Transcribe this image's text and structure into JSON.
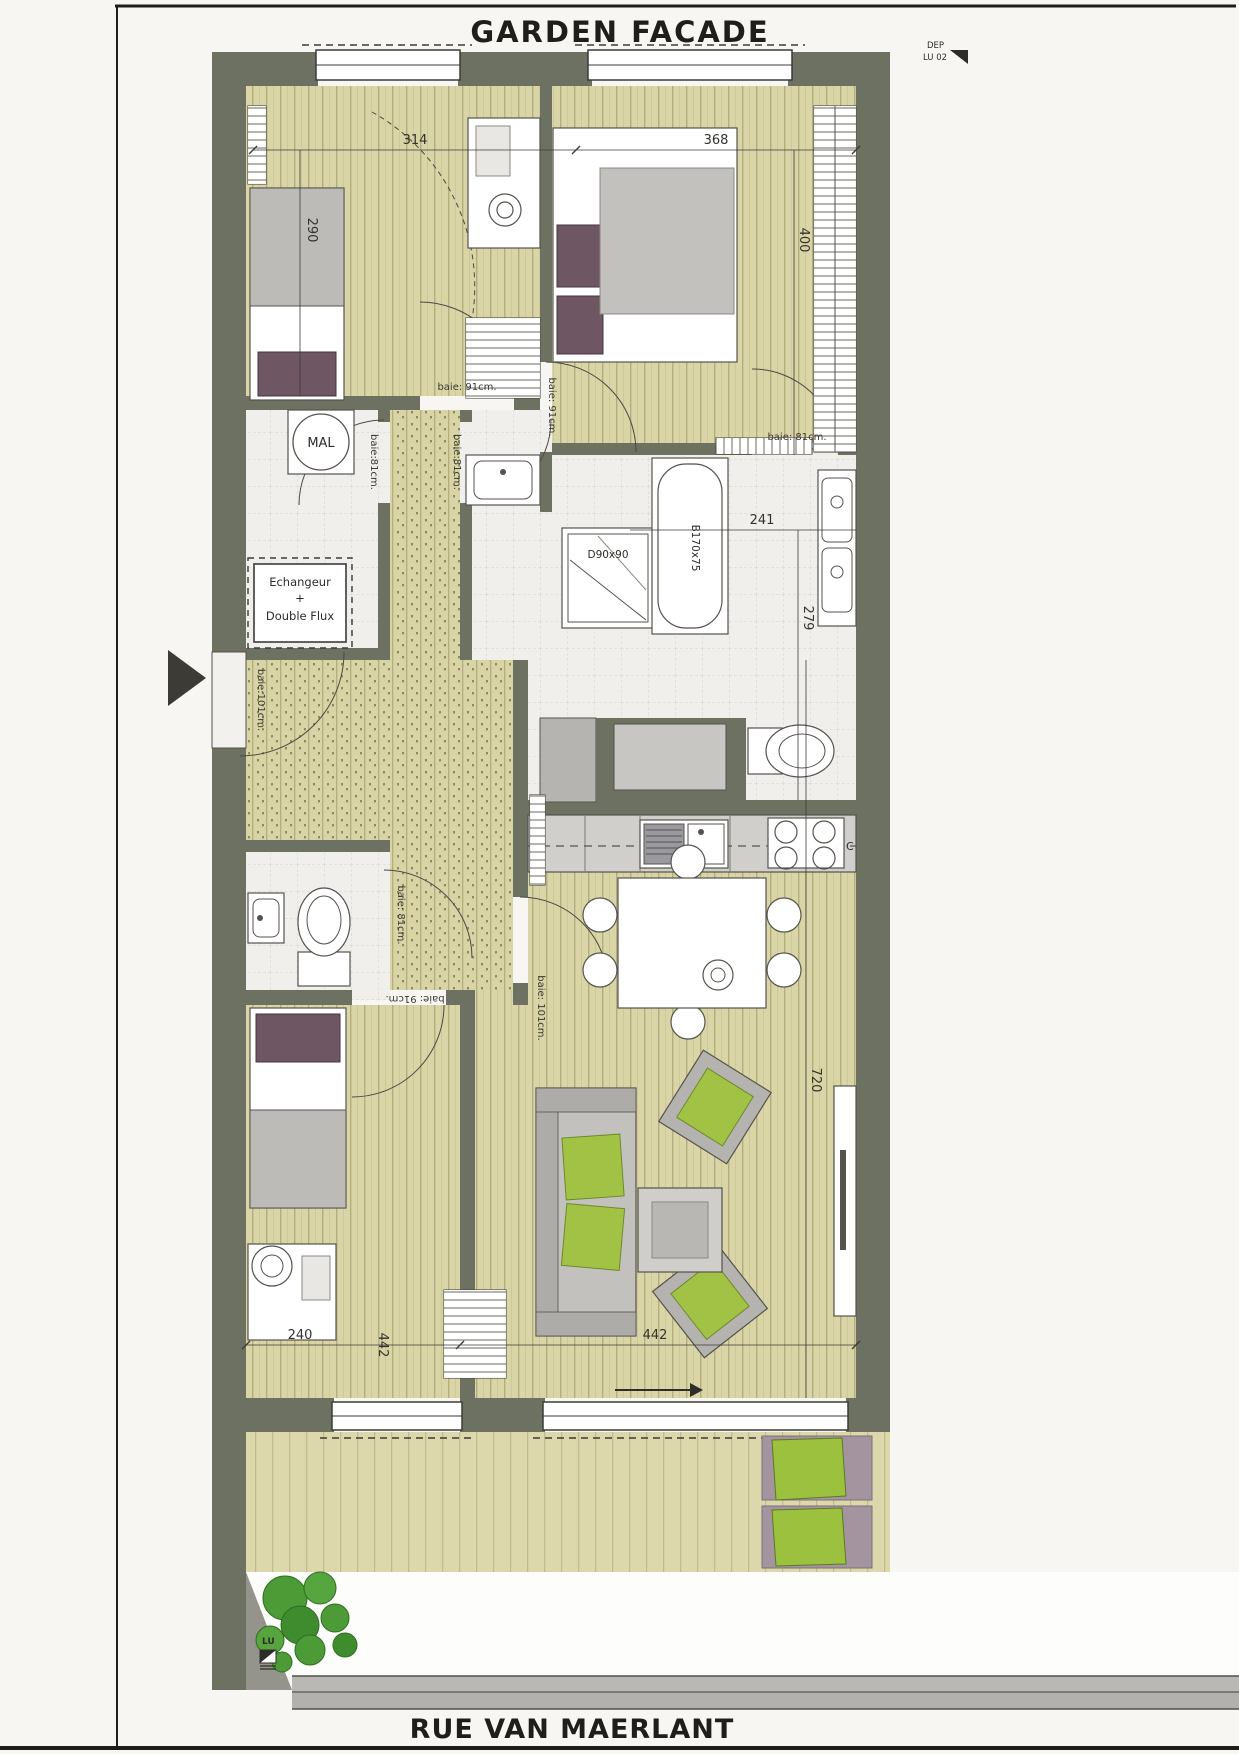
{
  "titles": {
    "garden_facade": "GARDEN FACADE",
    "street": "RUE VAN MAERLANT"
  },
  "sheet_marks": {
    "dep": "DEP",
    "lu02": "LU 02",
    "lu": "LU"
  },
  "equipment": {
    "washing_machine": "MAL",
    "hvac_line1": "Echangeur",
    "hvac_line2": "+",
    "hvac_line3": "Double Flux",
    "shower": "D90x90",
    "bathtub": "B170x75",
    "hob": "C"
  },
  "dimensions": {
    "bedroom1_width": "314",
    "bedroom2_width": "368",
    "bedroom1_depth": "290",
    "bedroom2_depth": "400",
    "bathroom_width": "241",
    "bathroom_depth": "279",
    "living_length": "720",
    "bedroom3_length": "442",
    "bedroom3_width": "240",
    "living_width": "442"
  },
  "door_labels": {
    "bedroom1_door": "baie: 91cm.",
    "bedroom2_door": "baie: 91cm.",
    "bathroom_top_door": "baie: 81cm.",
    "laundry_door": "baie:81cm.",
    "hall_door": "baie:81cm.",
    "entrance_door": "baie:101cm.",
    "wc_door": "baie: 81cm.",
    "living_door": "baie: 101cm.",
    "bedroom3_door": "baie: 91cm."
  }
}
